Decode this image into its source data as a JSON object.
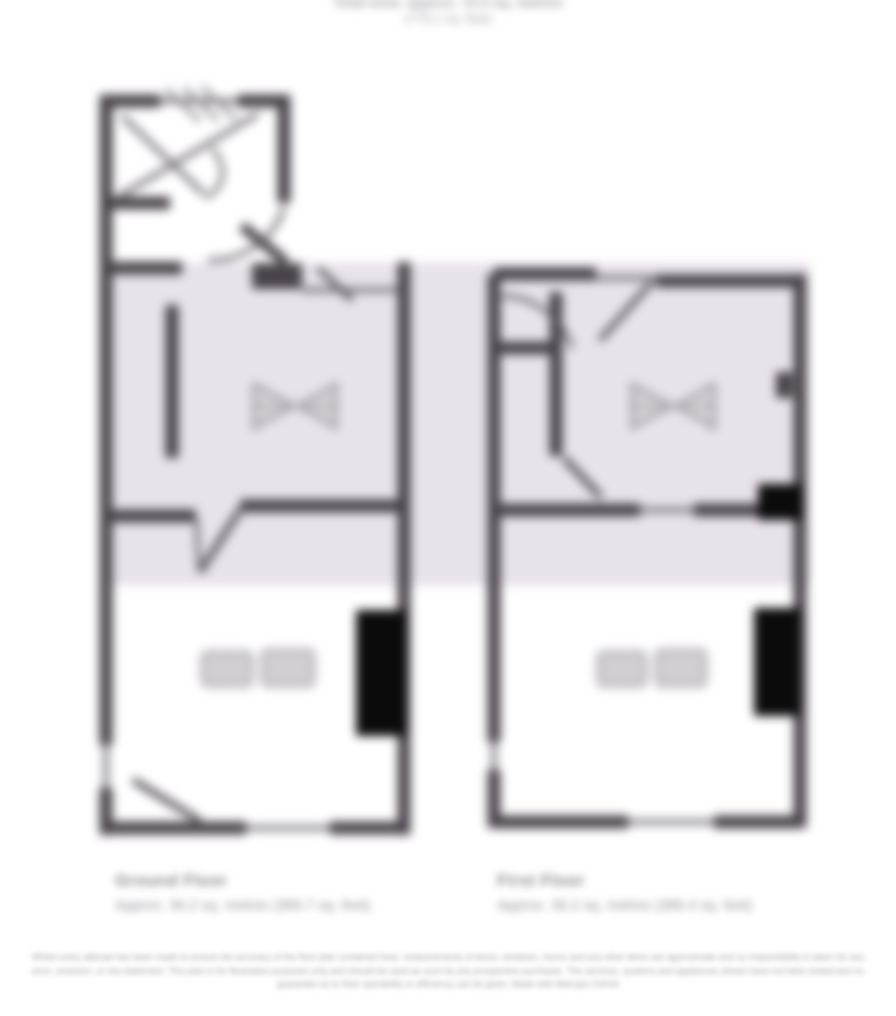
{
  "title": {
    "line1": "Total area: approx. 72.4 sq. metres",
    "line2": "(779.1 sq. feet)"
  },
  "floors": [
    {
      "name": "Ground Floor",
      "area_label": "Approx. 36.2 sq. metres (389.7 sq. feet)"
    },
    {
      "name": "First Floor",
      "area_label": "Approx. 36.2 sq. metres (389.4 sq. feet)"
    }
  ],
  "disclaimer": "Whilst every attempt has been made to ensure the accuracy of the floor plan contained here, measurements of doors, windows, rooms and any other items are approximate and no responsibility is taken for any error, omission, or mis-statement. This plan is for illustrative purposes only and should be used as such by any prospective purchaser. The services, systems and appliances shown have not been tested and no guarantee as to their operability or efficiency can be given. Made with Metropix ©2016",
  "colors": {
    "wall": "#49444a",
    "wall_thin": "#716d72",
    "highlight_band": "#e8e2ea",
    "chimney_black": "#0b0b0b",
    "symbol_gray": "#a5a2a6",
    "text_gray": "#8d8a8e"
  }
}
